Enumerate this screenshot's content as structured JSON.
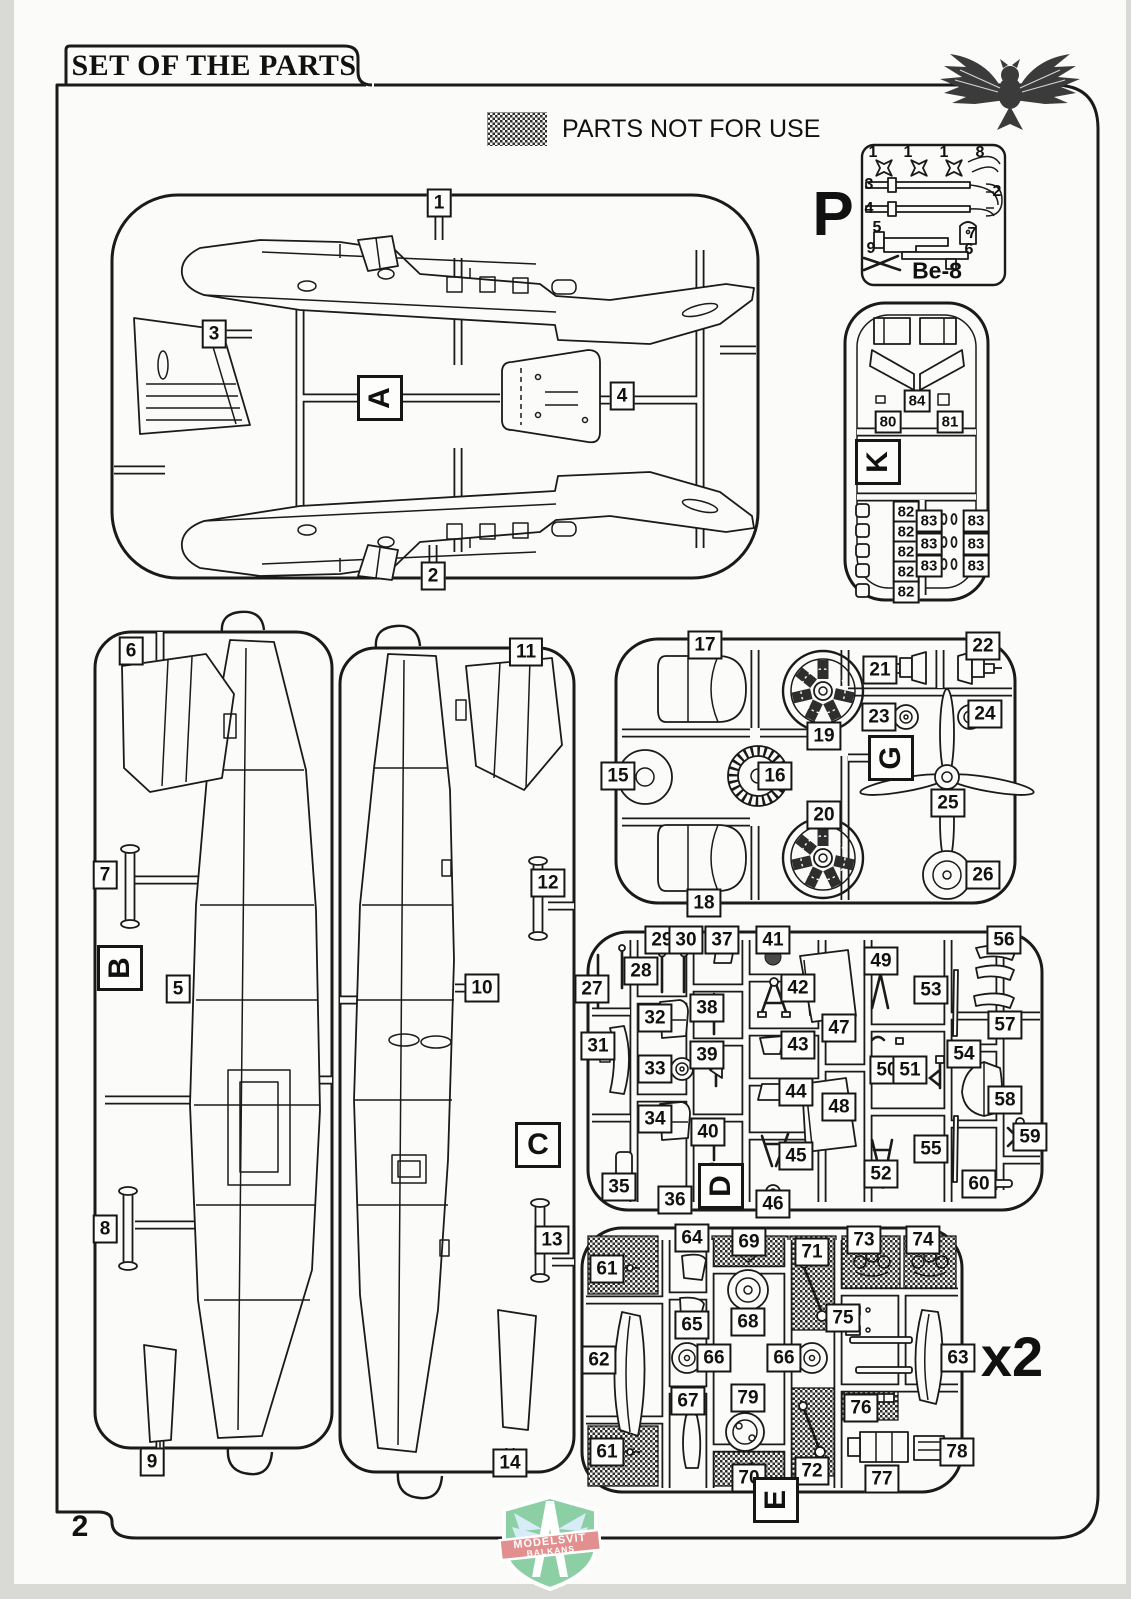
{
  "page": {
    "title": "SET OF THE PARTS",
    "page_number": "2",
    "legend_label": "PARTS NOT FOR USE",
    "sprue_p_name": "Be-8",
    "duplicate_note": "x2"
  },
  "brand": {
    "line1": "MODELSVIT",
    "line2": "BALKANS"
  },
  "icons": {
    "top_right": "owl-logo",
    "bottom_center": "modelsvit-shield-logo",
    "legend_swatch": "hatched-not-for-use-swatch"
  },
  "colors": {
    "ink": "#1a1a1a",
    "paper": "#fbfbf9",
    "scan_bg": "#d9d9d6",
    "logo_green": "#8ccfa4",
    "logo_red": "#e28f90",
    "logo_blue": "#d7ecf7"
  },
  "sprue_letters": [
    {
      "sprue": "P",
      "text": "P",
      "x": 833,
      "y": 215,
      "cls": "plain"
    },
    {
      "sprue": "A",
      "text": "A",
      "x": 380,
      "y": 398,
      "cls": "rot"
    },
    {
      "sprue": "B",
      "text": "B",
      "x": 120,
      "y": 968,
      "cls": "rot"
    },
    {
      "sprue": "C",
      "text": "C",
      "x": 538,
      "y": 1145,
      "cls": ""
    },
    {
      "sprue": "D",
      "text": "D",
      "x": 721,
      "y": 1186,
      "cls": "rot"
    },
    {
      "sprue": "E",
      "text": "E",
      "x": 776,
      "y": 1500,
      "cls": "rot"
    },
    {
      "sprue": "G",
      "text": "G",
      "x": 891,
      "y": 758,
      "cls": "rot"
    },
    {
      "sprue": "K",
      "text": "K",
      "x": 878,
      "y": 462,
      "cls": "rot"
    }
  ],
  "part_labels": [
    {
      "sprue": "A",
      "text": "1",
      "x": 439,
      "y": 203
    },
    {
      "sprue": "A",
      "text": "3",
      "x": 214,
      "y": 334
    },
    {
      "sprue": "A",
      "text": "4",
      "x": 622,
      "y": 396
    },
    {
      "sprue": "A",
      "text": "2",
      "x": 433,
      "y": 576
    },
    {
      "sprue": "B",
      "text": "6",
      "x": 131,
      "y": 651
    },
    {
      "sprue": "B",
      "text": "7",
      "x": 105,
      "y": 875
    },
    {
      "sprue": "B",
      "text": "5",
      "x": 178,
      "y": 989
    },
    {
      "sprue": "B",
      "text": "8",
      "x": 105,
      "y": 1229
    },
    {
      "sprue": "B",
      "text": "9",
      "x": 152,
      "y": 1462
    },
    {
      "sprue": "C",
      "text": "11",
      "x": 526,
      "y": 652
    },
    {
      "sprue": "C",
      "text": "12",
      "x": 548,
      "y": 883
    },
    {
      "sprue": "C",
      "text": "10",
      "x": 482,
      "y": 988
    },
    {
      "sprue": "C",
      "text": "13",
      "x": 552,
      "y": 1240
    },
    {
      "sprue": "C",
      "text": "14",
      "x": 510,
      "y": 1463
    },
    {
      "sprue": "G",
      "text": "17",
      "x": 705,
      "y": 645
    },
    {
      "sprue": "G",
      "text": "22",
      "x": 983,
      "y": 646
    },
    {
      "sprue": "G",
      "text": "21",
      "x": 880,
      "y": 670
    },
    {
      "sprue": "G",
      "text": "23",
      "x": 879,
      "y": 717
    },
    {
      "sprue": "G",
      "text": "24",
      "x": 985,
      "y": 714
    },
    {
      "sprue": "G",
      "text": "19",
      "x": 824,
      "y": 736
    },
    {
      "sprue": "G",
      "text": "15",
      "x": 618,
      "y": 776
    },
    {
      "sprue": "G",
      "text": "16",
      "x": 775,
      "y": 776
    },
    {
      "sprue": "G",
      "text": "25",
      "x": 948,
      "y": 803
    },
    {
      "sprue": "G",
      "text": "20",
      "x": 824,
      "y": 815
    },
    {
      "sprue": "G",
      "text": "26",
      "x": 983,
      "y": 875
    },
    {
      "sprue": "G",
      "text": "18",
      "x": 704,
      "y": 903
    },
    {
      "sprue": "D",
      "text": "29",
      "x": 662,
      "y": 940
    },
    {
      "sprue": "D",
      "text": "30",
      "x": 686,
      "y": 940
    },
    {
      "sprue": "D",
      "text": "37",
      "x": 722,
      "y": 940
    },
    {
      "sprue": "D",
      "text": "41",
      "x": 773,
      "y": 940
    },
    {
      "sprue": "D",
      "text": "56",
      "x": 1004,
      "y": 940
    },
    {
      "sprue": "D",
      "text": "49",
      "x": 881,
      "y": 961
    },
    {
      "sprue": "D",
      "text": "28",
      "x": 641,
      "y": 971
    },
    {
      "sprue": "D",
      "text": "27",
      "x": 592,
      "y": 989
    },
    {
      "sprue": "D",
      "text": "42",
      "x": 798,
      "y": 988
    },
    {
      "sprue": "D",
      "text": "53",
      "x": 931,
      "y": 990
    },
    {
      "sprue": "D",
      "text": "38",
      "x": 707,
      "y": 1008
    },
    {
      "sprue": "D",
      "text": "32",
      "x": 655,
      "y": 1018
    },
    {
      "sprue": "D",
      "text": "57",
      "x": 1005,
      "y": 1025
    },
    {
      "sprue": "D",
      "text": "47",
      "x": 839,
      "y": 1028
    },
    {
      "sprue": "D",
      "text": "31",
      "x": 598,
      "y": 1046
    },
    {
      "sprue": "D",
      "text": "43",
      "x": 798,
      "y": 1045
    },
    {
      "sprue": "D",
      "text": "39",
      "x": 707,
      "y": 1055
    },
    {
      "sprue": "D",
      "text": "54",
      "x": 964,
      "y": 1054
    },
    {
      "sprue": "D",
      "text": "33",
      "x": 655,
      "y": 1069
    },
    {
      "sprue": "D",
      "text": "50",
      "x": 887,
      "y": 1070
    },
    {
      "sprue": "D",
      "text": "51",
      "x": 910,
      "y": 1070
    },
    {
      "sprue": "D",
      "text": "44",
      "x": 796,
      "y": 1092
    },
    {
      "sprue": "D",
      "text": "58",
      "x": 1005,
      "y": 1100
    },
    {
      "sprue": "D",
      "text": "48",
      "x": 839,
      "y": 1107
    },
    {
      "sprue": "D",
      "text": "34",
      "x": 655,
      "y": 1119
    },
    {
      "sprue": "D",
      "text": "40",
      "x": 708,
      "y": 1132
    },
    {
      "sprue": "D",
      "text": "59",
      "x": 1030,
      "y": 1137
    },
    {
      "sprue": "D",
      "text": "55",
      "x": 931,
      "y": 1149
    },
    {
      "sprue": "D",
      "text": "45",
      "x": 796,
      "y": 1156
    },
    {
      "sprue": "D",
      "text": "52",
      "x": 881,
      "y": 1174
    },
    {
      "sprue": "D",
      "text": "35",
      "x": 619,
      "y": 1187
    },
    {
      "sprue": "D",
      "text": "36",
      "x": 675,
      "y": 1200
    },
    {
      "sprue": "D",
      "text": "46",
      "x": 773,
      "y": 1204
    },
    {
      "sprue": "D",
      "text": "60",
      "x": 979,
      "y": 1184
    },
    {
      "sprue": "E",
      "text": "64",
      "x": 692,
      "y": 1238
    },
    {
      "sprue": "E",
      "text": "69",
      "x": 749,
      "y": 1242
    },
    {
      "sprue": "E",
      "text": "73",
      "x": 864,
      "y": 1240
    },
    {
      "sprue": "E",
      "text": "74",
      "x": 923,
      "y": 1240
    },
    {
      "sprue": "E",
      "text": "61",
      "x": 607,
      "y": 1269
    },
    {
      "sprue": "E",
      "text": "71",
      "x": 812,
      "y": 1252
    },
    {
      "sprue": "E",
      "text": "75",
      "x": 843,
      "y": 1318
    },
    {
      "sprue": "E",
      "text": "65",
      "x": 692,
      "y": 1325
    },
    {
      "sprue": "E",
      "text": "68",
      "x": 748,
      "y": 1322
    },
    {
      "sprue": "E",
      "text": "62",
      "x": 599,
      "y": 1360
    },
    {
      "sprue": "E",
      "text": "66",
      "x": 714,
      "y": 1358
    },
    {
      "sprue": "E",
      "text": "66",
      "x": 784,
      "y": 1358
    },
    {
      "sprue": "E",
      "text": "63",
      "x": 958,
      "y": 1358
    },
    {
      "sprue": "E",
      "text": "67",
      "x": 688,
      "y": 1401
    },
    {
      "sprue": "E",
      "text": "79",
      "x": 748,
      "y": 1398
    },
    {
      "sprue": "E",
      "text": "76",
      "x": 861,
      "y": 1408
    },
    {
      "sprue": "E",
      "text": "61",
      "x": 607,
      "y": 1452
    },
    {
      "sprue": "E",
      "text": "70",
      "x": 749,
      "y": 1478
    },
    {
      "sprue": "E",
      "text": "72",
      "x": 812,
      "y": 1471
    },
    {
      "sprue": "E",
      "text": "77",
      "x": 882,
      "y": 1479
    },
    {
      "sprue": "E",
      "text": "78",
      "x": 957,
      "y": 1452
    },
    {
      "sprue": "K",
      "text": "84",
      "x": 917,
      "y": 401,
      "cls": "sm"
    },
    {
      "sprue": "K",
      "text": "80",
      "x": 888,
      "y": 422,
      "cls": "sm"
    },
    {
      "sprue": "K",
      "text": "81",
      "x": 950,
      "y": 422,
      "cls": "sm"
    },
    {
      "sprue": "K",
      "text": "82",
      "x": 906,
      "y": 512,
      "cls": "sm"
    },
    {
      "sprue": "K",
      "text": "82",
      "x": 906,
      "y": 532,
      "cls": "sm"
    },
    {
      "sprue": "K",
      "text": "82",
      "x": 906,
      "y": 552,
      "cls": "sm"
    },
    {
      "sprue": "K",
      "text": "82",
      "x": 906,
      "y": 572,
      "cls": "sm"
    },
    {
      "sprue": "K",
      "text": "82",
      "x": 906,
      "y": 592,
      "cls": "sm"
    },
    {
      "sprue": "K",
      "text": "83",
      "x": 929,
      "y": 521,
      "cls": "sm"
    },
    {
      "sprue": "K",
      "text": "83",
      "x": 929,
      "y": 544,
      "cls": "sm"
    },
    {
      "sprue": "K",
      "text": "83",
      "x": 929,
      "y": 566,
      "cls": "sm"
    },
    {
      "sprue": "K",
      "text": "83",
      "x": 976,
      "y": 521,
      "cls": "sm"
    },
    {
      "sprue": "K",
      "text": "83",
      "x": 976,
      "y": 544,
      "cls": "sm"
    },
    {
      "sprue": "K",
      "text": "83",
      "x": 976,
      "y": 566,
      "cls": "sm"
    }
  ],
  "pe_part_numbers": [
    {
      "text": "1",
      "x": 873,
      "y": 153
    },
    {
      "text": "1",
      "x": 908,
      "y": 153
    },
    {
      "text": "1",
      "x": 944,
      "y": 153
    },
    {
      "text": "8",
      "x": 980,
      "y": 153
    },
    {
      "text": "3",
      "x": 869,
      "y": 185
    },
    {
      "text": "2",
      "x": 997,
      "y": 192
    },
    {
      "text": "4",
      "x": 869,
      "y": 209
    },
    {
      "text": "5",
      "x": 877,
      "y": 228
    },
    {
      "text": "7",
      "x": 972,
      "y": 234
    },
    {
      "text": "9",
      "x": 871,
      "y": 249
    },
    {
      "text": "6",
      "x": 969,
      "y": 250
    }
  ]
}
